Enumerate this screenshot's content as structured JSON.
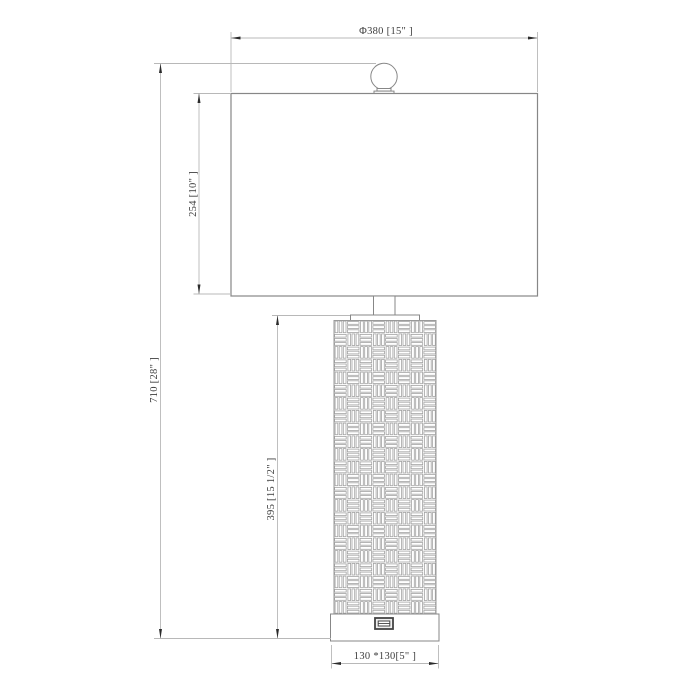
{
  "drawing": {
    "type": "table-lamp-technical-drawing",
    "dimensions": {
      "shade_width": "Φ380 [15\" ]",
      "overall_height": "710 [28\" ]",
      "shade_height": "254 [10\" ]",
      "body_height": "395 [15 1/2\" ]",
      "base_size": "130 *130[5\" ]"
    },
    "features": {
      "usb_port": "usb-port",
      "pattern": "basket-weave"
    },
    "colors": {
      "background": "#ffffff",
      "object_line": "#878787",
      "pattern_line": "#a3a3a3",
      "dimension_line": "#b8b8b8",
      "arrow": "#2b2b2b",
      "text": "#3d3d3d"
    }
  }
}
